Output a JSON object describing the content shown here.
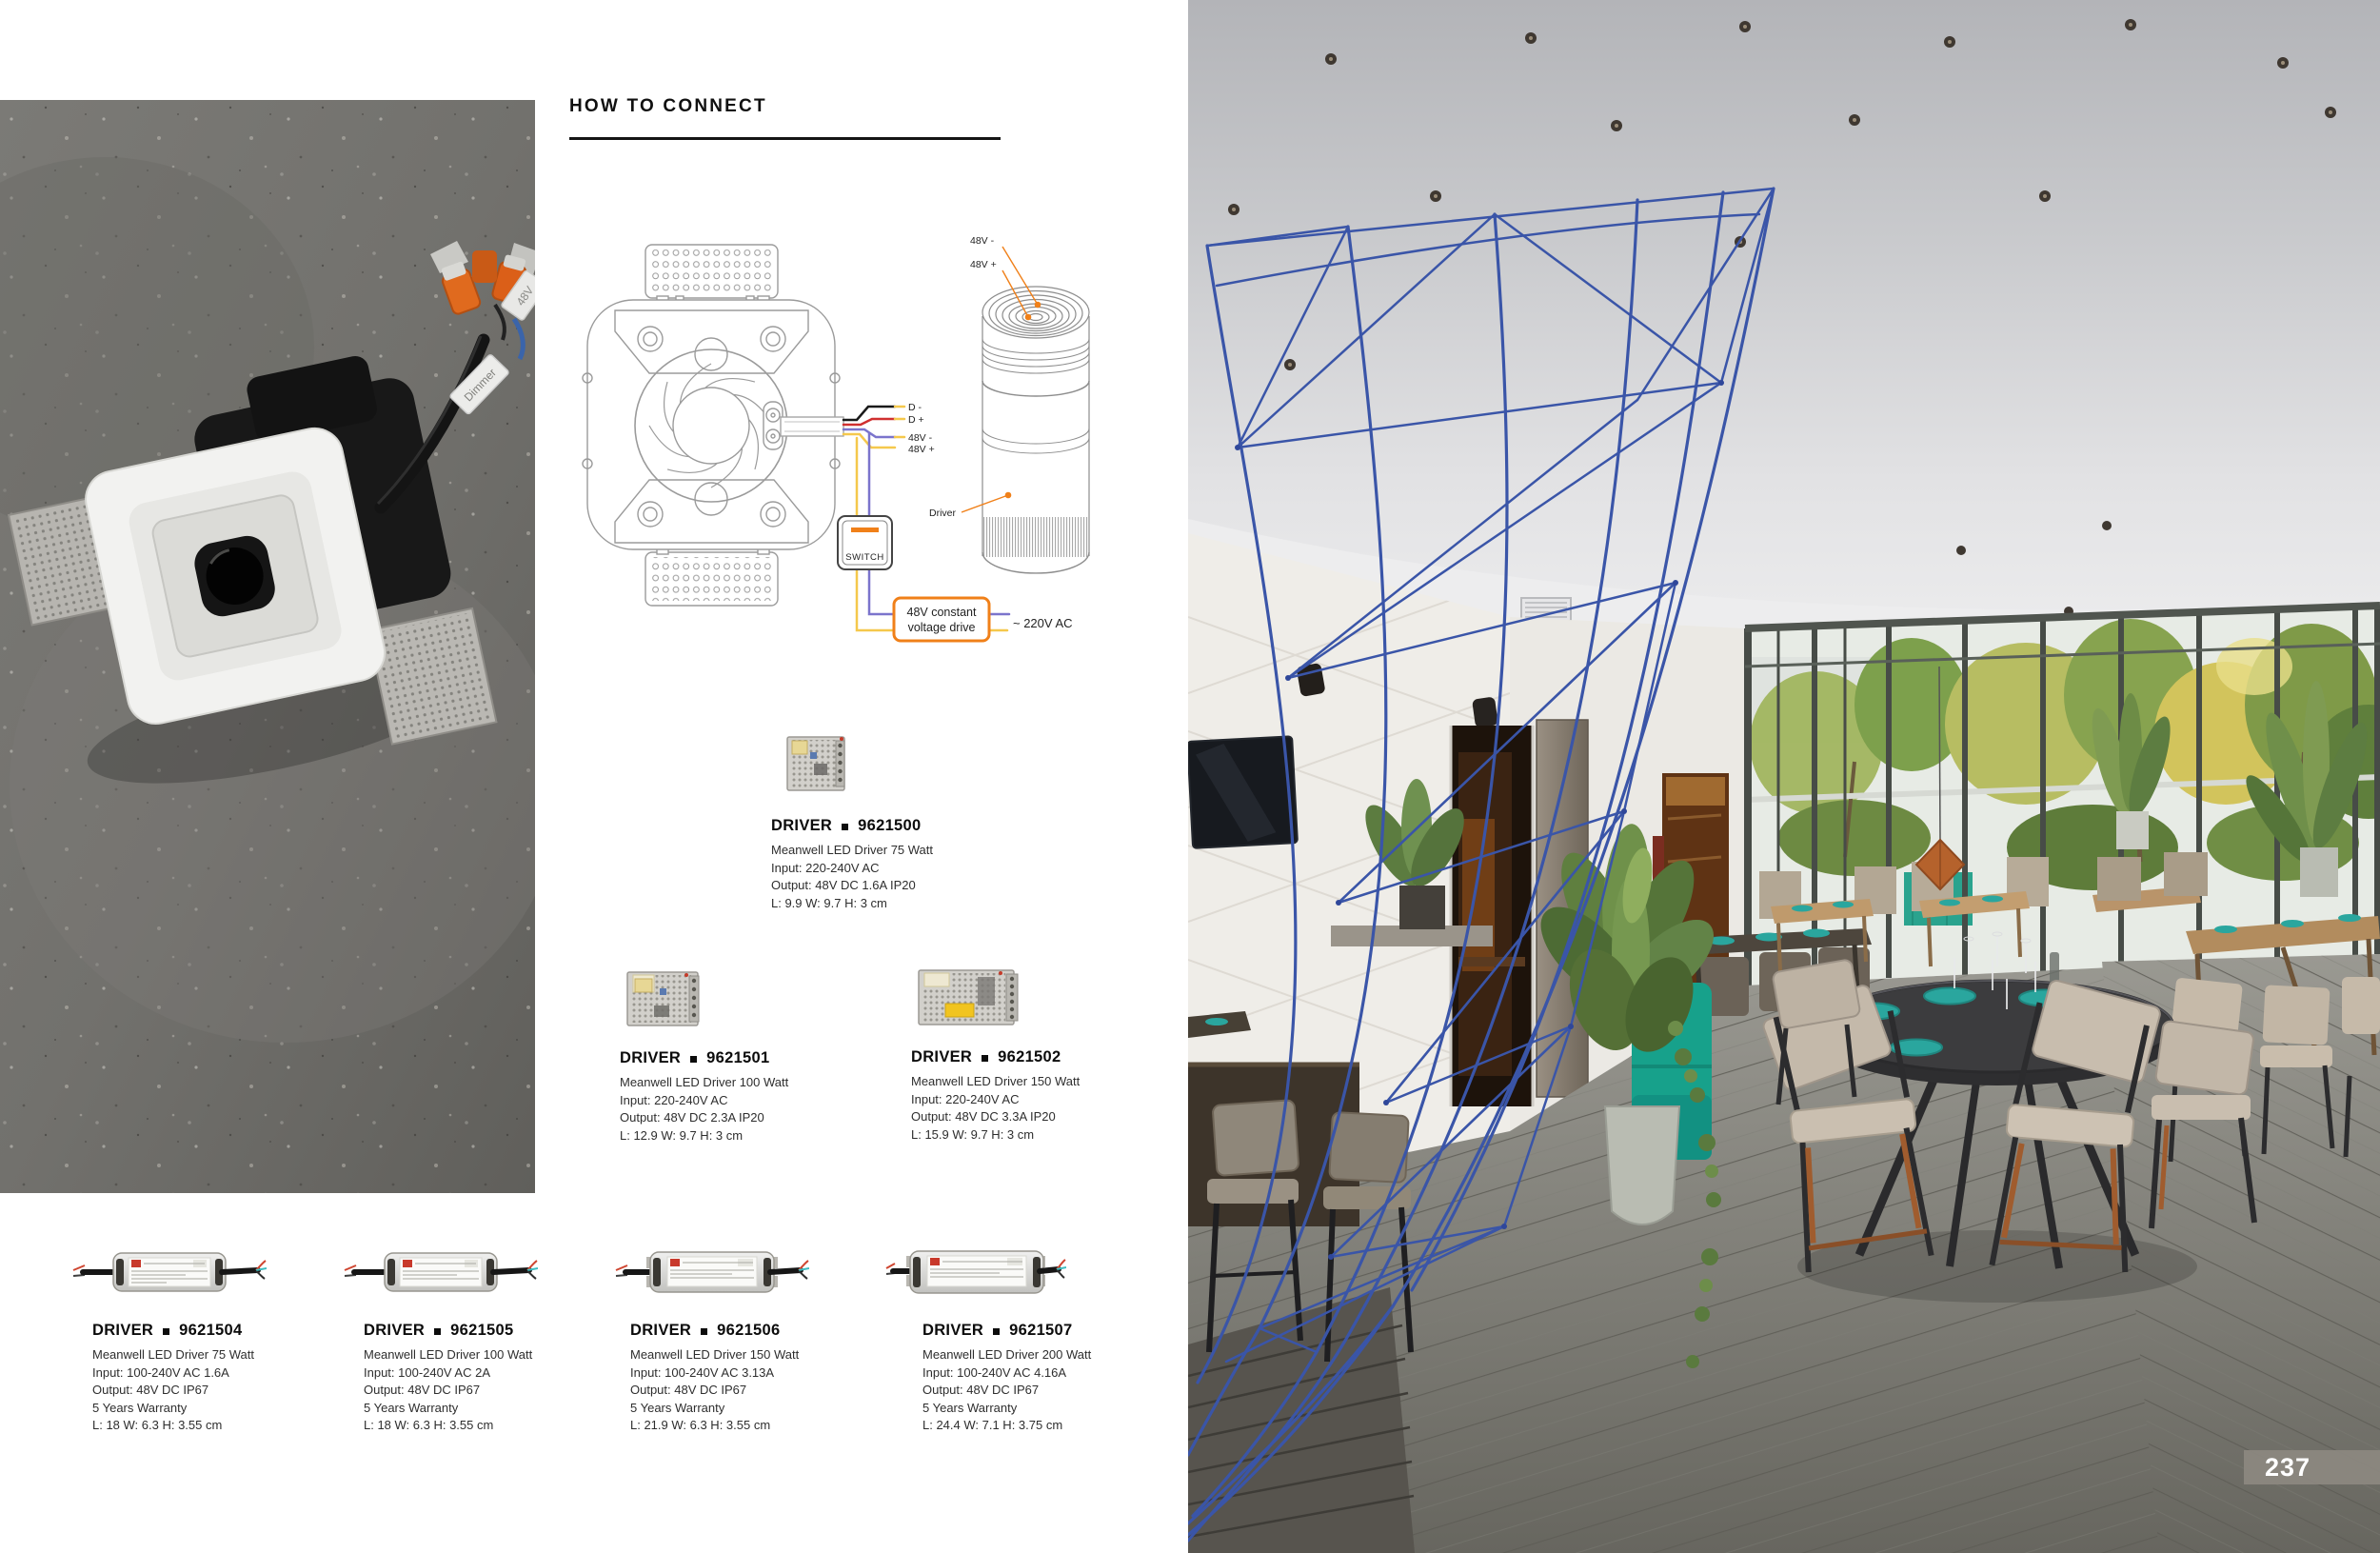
{
  "page_number": "237",
  "section": {
    "title": "HOW TO CONNECT"
  },
  "diagram": {
    "module_top_labels": [
      "48V -",
      "48V +"
    ],
    "wire_labels": [
      "D -",
      "D +",
      "48V -",
      "48V +"
    ],
    "module_label": "Driver",
    "switch_label": "SWITCH",
    "psu_lines": [
      "48V constant",
      "voltage drive"
    ],
    "mains_label": "~ 220V AC"
  },
  "photo_tags": {
    "dimmer": "Dimmer",
    "voltage": "48V"
  },
  "drivers": [
    {
      "label": "DRIVER",
      "code": "9621500",
      "specs": [
        "Meanwell LED Driver 75 Watt",
        "Input: 220-240V AC",
        "Output: 48V DC 1.6A IP20",
        "L: 9.9 W: 9.7 H: 3 cm"
      ]
    },
    {
      "label": "DRIVER",
      "code": "9621501",
      "specs": [
        "Meanwell LED Driver 100 Watt",
        "Input: 220-240V AC",
        "Output: 48V DC 2.3A IP20",
        "L: 12.9 W: 9.7 H: 3 cm"
      ]
    },
    {
      "label": "DRIVER",
      "code": "9621502",
      "specs": [
        "Meanwell LED Driver 150 Watt",
        "Input: 220-240V AC",
        "Output: 48V DC 3.3A IP20",
        "L: 15.9 W: 9.7 H: 3 cm"
      ]
    },
    {
      "label": "DRIVER",
      "code": "9621504",
      "specs": [
        "Meanwell LED Driver 75 Watt",
        "Input: 100-240V AC 1.6A",
        "Output: 48V DC IP67",
        "5 Years Warranty",
        "L: 18 W: 6.3 H: 3.55 cm"
      ]
    },
    {
      "label": "DRIVER",
      "code": "9621505",
      "specs": [
        "Meanwell LED Driver 100 Watt",
        "Input: 100-240V AC 2A",
        "Output: 48V DC IP67",
        "5 Years Warranty",
        "L: 18 W: 6.3 H: 3.55 cm"
      ]
    },
    {
      "label": "DRIVER",
      "code": "9621506",
      "specs": [
        "Meanwell LED Driver 150 Watt",
        "Input: 100-240V AC 3.13A",
        "Output: 48V DC IP67",
        "5 Years Warranty",
        "L: 21.9 W: 6.3 H: 3.55 cm"
      ]
    },
    {
      "label": "DRIVER",
      "code": "9621507",
      "specs": [
        "Meanwell LED Driver 200 Watt",
        "Input: 100-240V AC 4.16A",
        "Output: 48V DC IP67",
        "5 Years Warranty",
        "L: 24.4 W: 7.1 H: 3.75 cm"
      ]
    }
  ],
  "colors": {
    "accent_orange": "#ef7f1a",
    "wire_black": "#1a1a1a",
    "wire_red": "#d03030",
    "wire_blue": "#7b74cc",
    "wire_yellow": "#f5c84c",
    "net_blue": "#3a55a8",
    "plate_teal": "#2aa69e",
    "sofa_teal": "#17a18b"
  }
}
